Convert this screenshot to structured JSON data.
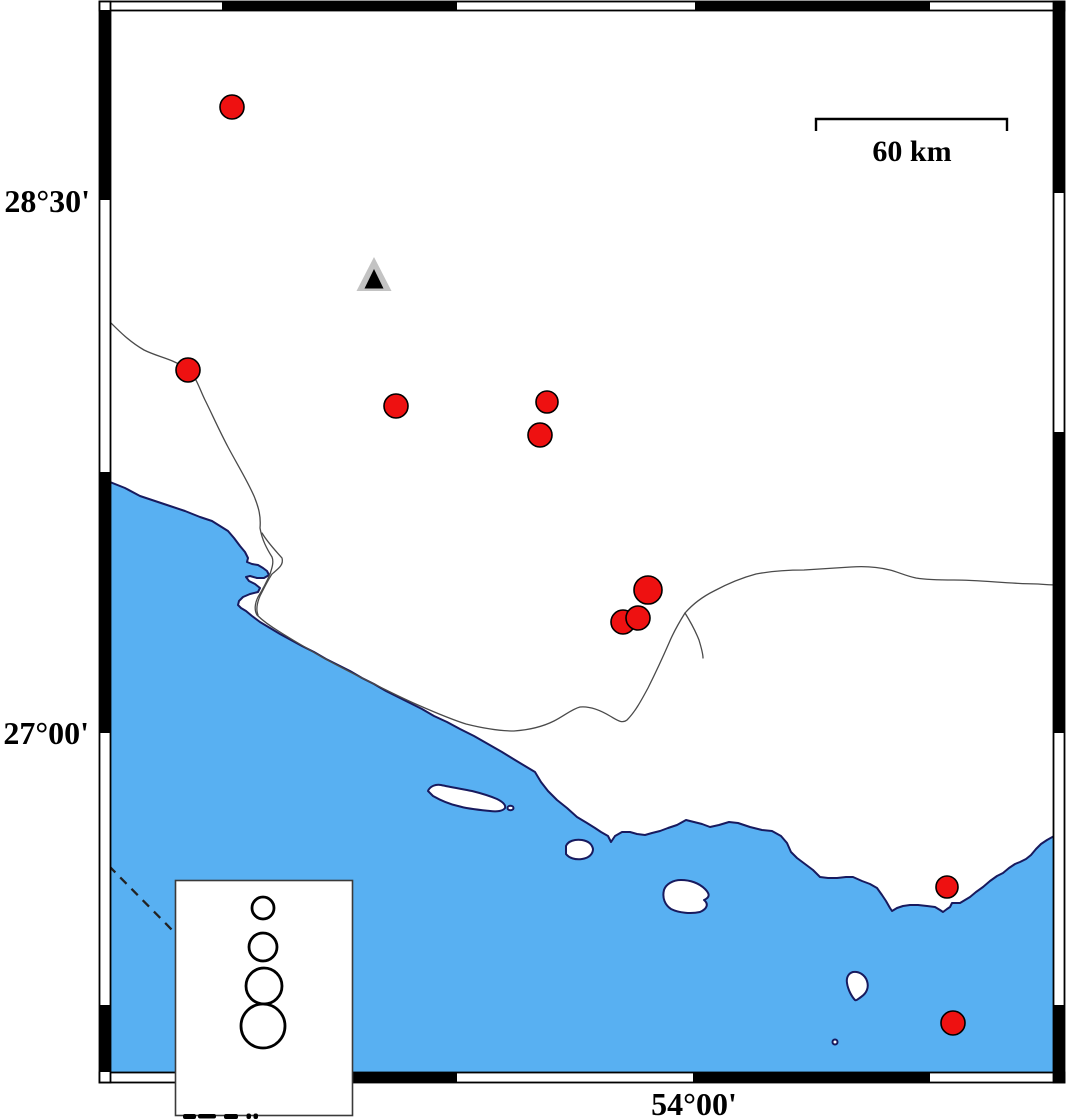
{
  "figure": {
    "type": "seismicity-map",
    "labels": {
      "lat_upper": "28°30'",
      "lat_lower": "27°00'",
      "lon_bottom": "54°00'",
      "scale_bar": "60 km"
    },
    "colors": {
      "sea": "#58b0f2",
      "land": "#ffffff",
      "coastline": "#181a5e",
      "epicenter_fill": "#ee1111",
      "epicenter_stroke": "#000000",
      "station_outer": "#c3c3c3",
      "station_inner": "#000000",
      "frame": "#000000"
    },
    "epicenters": [
      {
        "x": 232,
        "y": 107,
        "r": 12
      },
      {
        "x": 188,
        "y": 370,
        "r": 12
      },
      {
        "x": 396,
        "y": 406,
        "r": 12
      },
      {
        "x": 547,
        "y": 402,
        "r": 11
      },
      {
        "x": 540,
        "y": 435,
        "r": 12
      },
      {
        "x": 648,
        "y": 590,
        "r": 14
      },
      {
        "x": 623,
        "y": 622,
        "r": 12
      },
      {
        "x": 638,
        "y": 618,
        "r": 12
      },
      {
        "x": 947,
        "y": 887,
        "r": 11
      },
      {
        "x": 953,
        "y": 1023,
        "r": 12
      }
    ],
    "station": {
      "x": 374,
      "y": 257
    },
    "legend_circles": [
      {
        "cx": 263,
        "cy": 908,
        "r": 11
      },
      {
        "cx": 263,
        "cy": 947,
        "r": 14
      },
      {
        "cx": 264,
        "cy": 986,
        "r": 18
      },
      {
        "cx": 263,
        "cy": 1026,
        "r": 22
      }
    ]
  }
}
